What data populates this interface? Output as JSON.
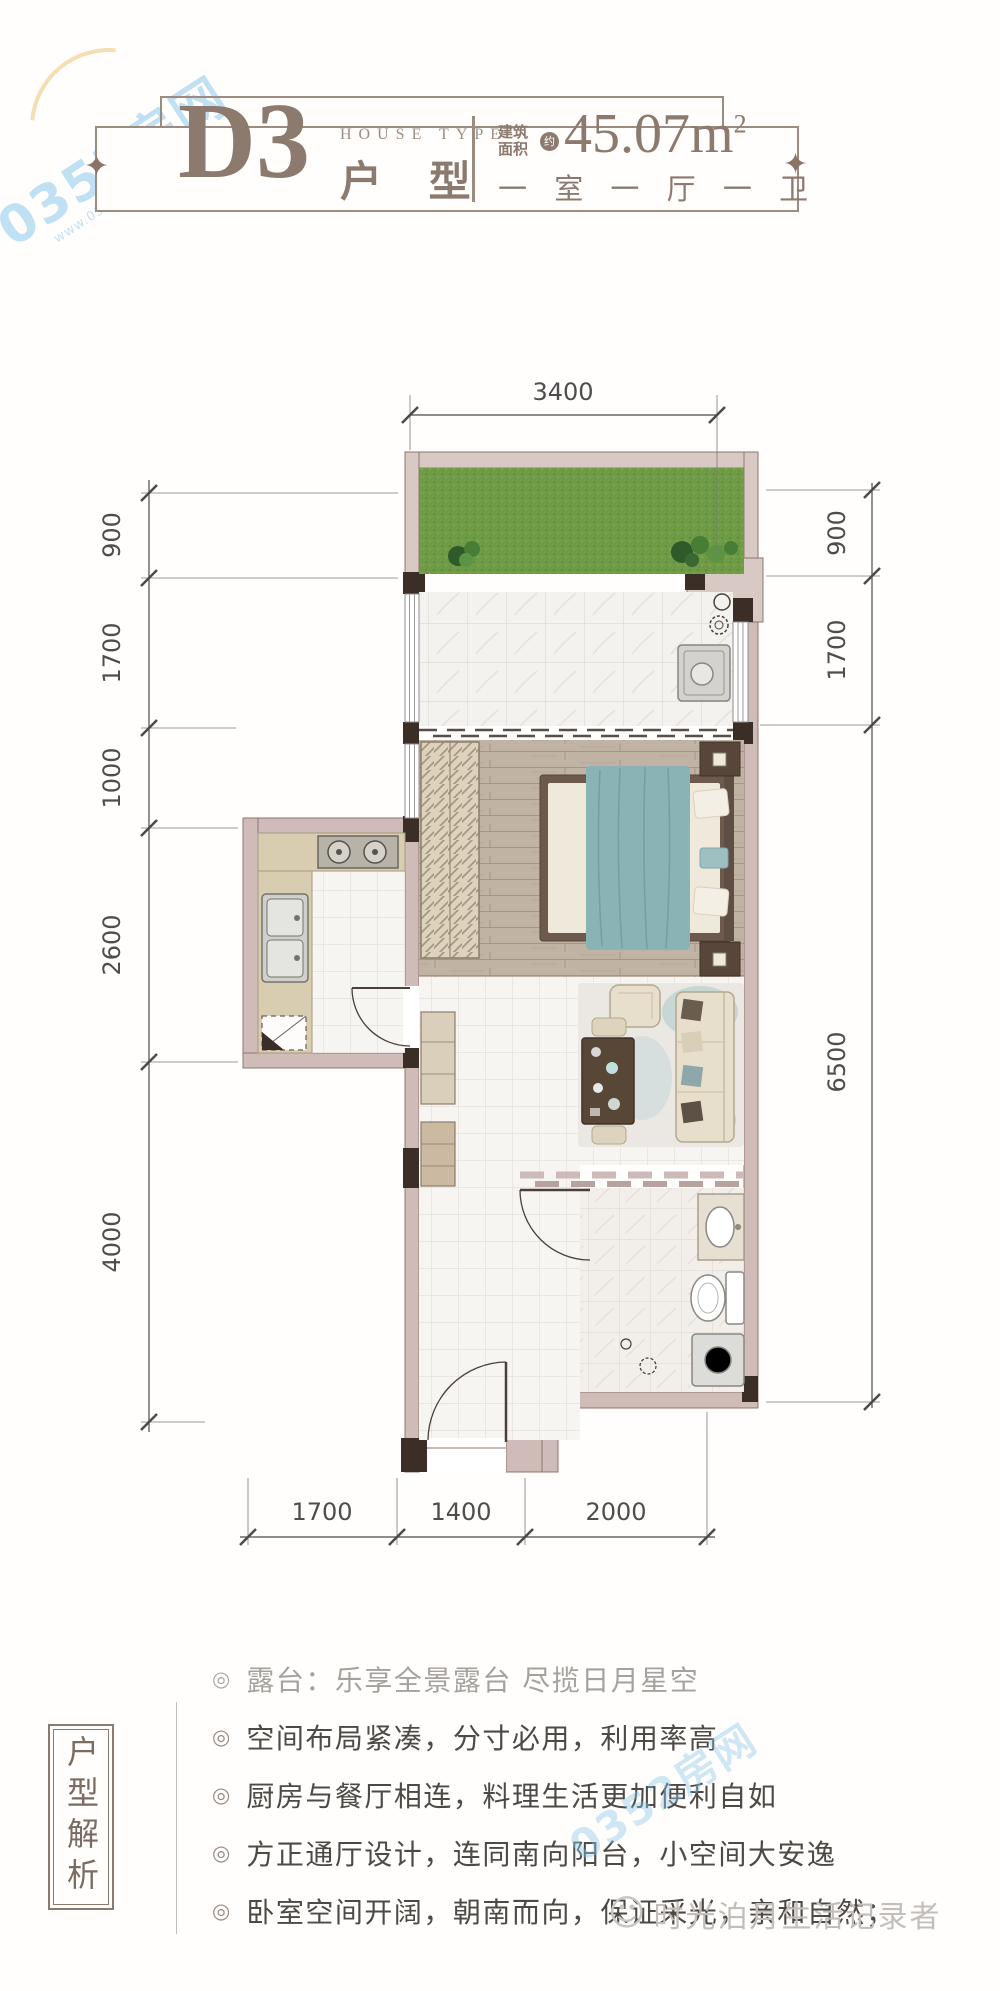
{
  "watermarks": {
    "brand": "0352房网",
    "brand_url": "www.0352fang.com",
    "footer_smiley": "☺",
    "footer_text": "时光泊月生活记录者"
  },
  "header": {
    "type_code": "D3",
    "house_type_label": "HOUSE TYPE",
    "type_suffix": "户 型",
    "area_prefix_line1": "建筑",
    "area_prefix_line2": "面积",
    "area_approx": "约",
    "area_value": "45.07m",
    "area_exponent": "2",
    "layout": "一 室 一 厅 一 卫",
    "ornament": "✦"
  },
  "plan": {
    "dims": {
      "top": [
        "3400"
      ],
      "left": [
        "900",
        "1700",
        "1000",
        "2600",
        "4000"
      ],
      "right": [
        "900",
        "1700",
        "6500"
      ],
      "bottom": [
        "1700",
        "1400",
        "2000"
      ]
    }
  },
  "analysis": {
    "title": "户型解析",
    "bullet_char": "◎",
    "bullets": [
      "露台：乐享全景露台  尽揽日月星空",
      "空间布局紧凑，分寸必用，利用率高",
      "厨房与餐厅相连，料理生活更加便利自如",
      "方正通厅设计，连同南向阳台，小空间大安逸",
      "卧室空间开阔，朝南而向，保证采光，亲和自然；"
    ]
  },
  "colors": {
    "accent_brown": "#8d7a6e",
    "wall_pink": "#cfbcb8",
    "wall_dark": "#3b2e26",
    "grass_green": "#6f9a46",
    "bed_teal": "#8ab3b6",
    "watermark_blue": "#8cc6e9"
  }
}
